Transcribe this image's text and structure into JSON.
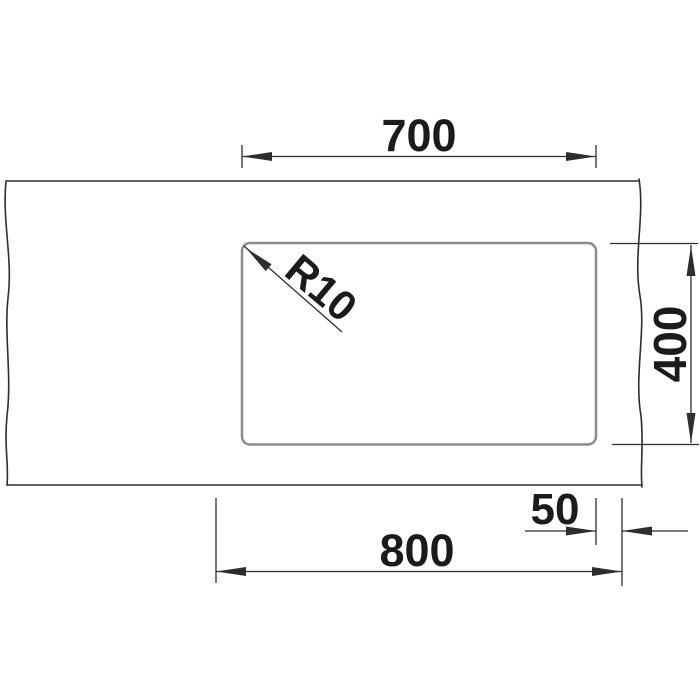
{
  "drawing": {
    "kind": "sink-cutout-installation-drawing-top-view",
    "labels": {
      "cutout_width": "700",
      "cutout_depth": "400",
      "base_width": "800",
      "side_clearance": "50",
      "corner_radius": "R10"
    },
    "values": {
      "cutout_width": 700,
      "cutout_depth": 400,
      "base_width": 800,
      "side_clearance": 50,
      "corner_radius": 10
    }
  },
  "colors": {
    "background": "#ffffff",
    "outline": "#2d2d2d",
    "cutout": "#8c8c8c",
    "dimension": "#2e2e2e",
    "text": "#1b1b1b"
  }
}
